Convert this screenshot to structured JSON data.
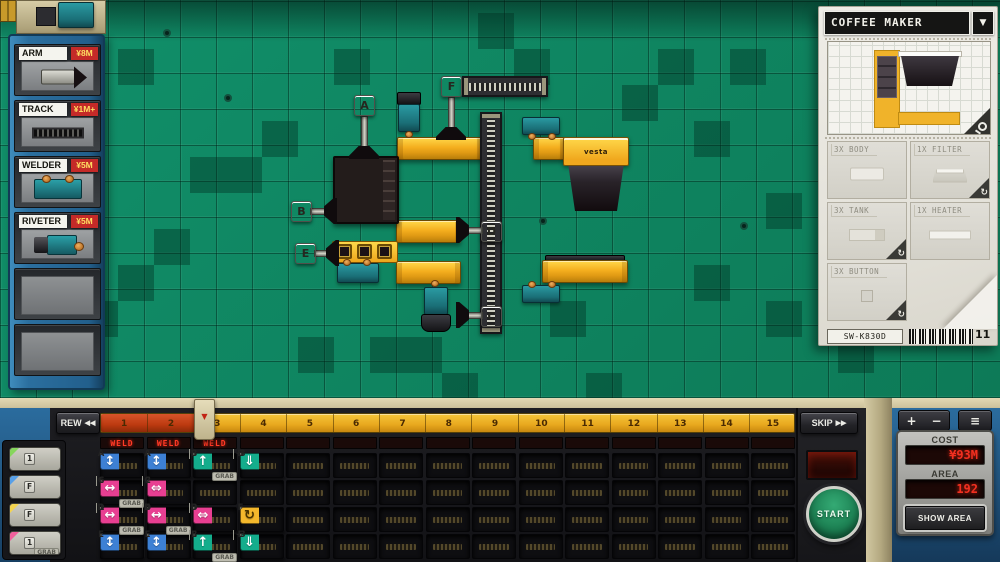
{
  "sidebar": {
    "items": [
      {
        "label": "ARM",
        "price": "¥8M",
        "image": "arm"
      },
      {
        "label": "TRACK",
        "price": "¥1M+",
        "image": "track"
      },
      {
        "label": "WELDER",
        "price": "¥5M",
        "image": "welder"
      },
      {
        "label": "RIVETER",
        "price": "¥5M",
        "image": "riveter"
      },
      {
        "label": "",
        "price": "",
        "image": "empty"
      },
      {
        "label": "",
        "price": "",
        "image": "empty"
      }
    ]
  },
  "product_panel": {
    "title": "COFFEE MAKER",
    "dropdown_icon": "▼",
    "rotate_icon": "↻",
    "parts": [
      {
        "label": "3X BODY",
        "shape": "body",
        "rotatable": false
      },
      {
        "label": "1X FILTER",
        "shape": "filter",
        "rotatable": true
      },
      {
        "label": "3X TANK",
        "shape": "tank",
        "rotatable": true
      },
      {
        "label": "1X HEATER",
        "shape": "heater",
        "rotatable": false
      },
      {
        "label": "3X BUTTON",
        "shape": "button",
        "rotatable": true
      }
    ],
    "sku": "SW-K830D",
    "order_count": "11"
  },
  "board": {
    "brand_label": "vesta",
    "tags": [
      "A",
      "B",
      "C",
      "D",
      "E",
      "F"
    ]
  },
  "transport": {
    "rew_label": "REW",
    "rew_icon": "◀◀",
    "skip_label": "SKIP",
    "skip_icon": "▶▶",
    "playhead_icon": "▼",
    "tick_labels": [
      "1",
      "2",
      "3",
      "4",
      "5",
      "6",
      "7",
      "8",
      "9",
      "10",
      "11",
      "12",
      "13",
      "14",
      "15"
    ],
    "led_labels": [
      "WELD",
      "WELD",
      "WELD"
    ]
  },
  "palette": {
    "grab_label": "GRAB",
    "rows": [
      {
        "icon": "↑",
        "corner": "#86d65c",
        "keys": "F 1",
        "grab": false
      },
      {
        "icon": "↕",
        "corner": "#58a0e8",
        "keys": "F",
        "grab": false
      },
      {
        "icon": "↻",
        "corner": "#f4d44f",
        "keys": "F",
        "grab": false
      },
      {
        "icon": "↔",
        "corner": "#f0609c",
        "keys": "F 1",
        "grab": true
      }
    ]
  },
  "card_colors": {
    "blue": "#3d80d4",
    "teal": "#14ad8c",
    "pink": "#e83f92",
    "yellow": "#f4b82c"
  },
  "program": {
    "grab_label": "GRAB",
    "cards": [
      {
        "col": 1,
        "row": 1,
        "icon": "↕",
        "color": "blue",
        "key": "A",
        "grab": false
      },
      {
        "col": 2,
        "row": 1,
        "icon": "↕",
        "color": "blue",
        "key": "A",
        "grab": false
      },
      {
        "col": 3,
        "row": 1,
        "icon": "↑",
        "color": "teal",
        "key": "B 3",
        "grab": true
      },
      {
        "col": 4,
        "row": 1,
        "icon": "⇓",
        "color": "teal",
        "key": "B -3",
        "grab": false
      },
      {
        "col": 1,
        "row": 2,
        "icon": "↔",
        "color": "pink",
        "key": "C 6",
        "grab": true
      },
      {
        "col": 2,
        "row": 2,
        "icon": "⇔",
        "color": "pink",
        "key": "C 2",
        "grab": false
      },
      {
        "col": 1,
        "row": 3,
        "icon": "↔",
        "color": "pink",
        "key": "D 1",
        "grab": true
      },
      {
        "col": 2,
        "row": 3,
        "icon": "↔",
        "color": "pink",
        "key": "D 4",
        "grab": true
      },
      {
        "col": 3,
        "row": 3,
        "icon": "⇔",
        "color": "pink",
        "key": "D 3",
        "grab": false
      },
      {
        "col": 4,
        "row": 3,
        "icon": "↻",
        "color": "yellow",
        "key": "F",
        "grab": false
      },
      {
        "col": 1,
        "row": 4,
        "icon": "↕",
        "color": "blue",
        "key": "E",
        "grab": false
      },
      {
        "col": 2,
        "row": 4,
        "icon": "↕",
        "color": "blue",
        "key": "E",
        "grab": false
      },
      {
        "col": 3,
        "row": 4,
        "icon": "↑",
        "color": "teal",
        "key": "E 3",
        "grab": true
      },
      {
        "col": 4,
        "row": 4,
        "icon": "⇓",
        "color": "teal",
        "key": "E -3",
        "grab": false
      }
    ]
  },
  "controls": {
    "start_label": "START",
    "plus_label": "+",
    "minus_label": "−",
    "menu_icon": "≡",
    "cost_label": "COST",
    "cost_value": "¥93M",
    "area_label": "AREA",
    "area_value": "192",
    "show_area_label": "SHOW AREA"
  }
}
